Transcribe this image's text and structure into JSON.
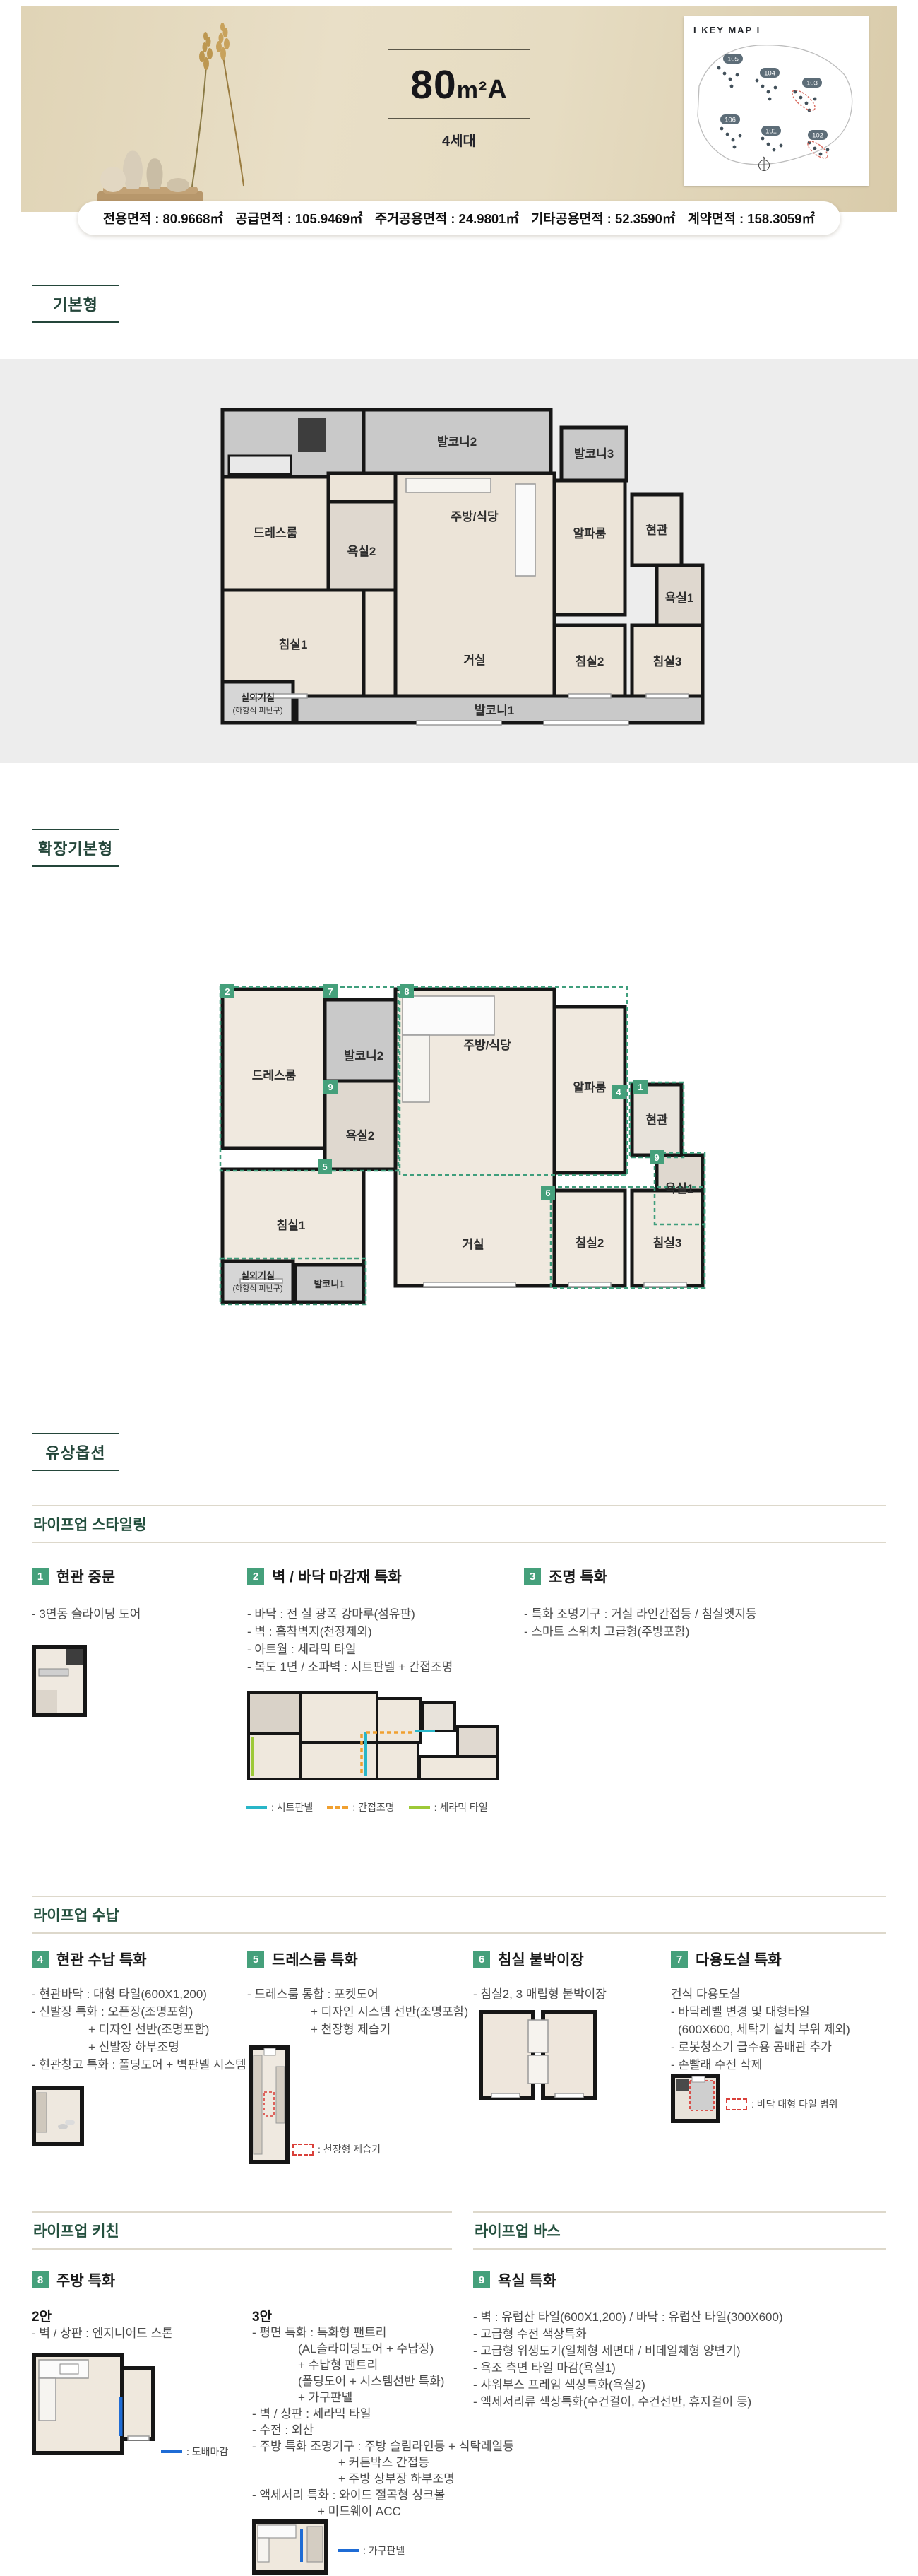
{
  "header": {
    "title_area": "80",
    "title_unit": "m²",
    "title_variant": "A",
    "units_count": "4세대",
    "keymap_title": "I KEY MAP I",
    "keymap_buildings": [
      "105",
      "104",
      "103",
      "106",
      "101",
      "102"
    ],
    "compass_label": "N",
    "area_info": [
      "전용면적 : 80.9668㎡",
      "공급면적 : 105.9469㎡",
      "주거공용면적 : 24.9801㎡",
      "기타공용면적 : 52.3590㎡",
      "계약면적 : 158.3059㎡"
    ]
  },
  "section_labels": {
    "basic": "기본형",
    "extended": "확장기본형",
    "paid": "유상옵션"
  },
  "plan_basic": {
    "rooms": {
      "balcony2": "발코니2",
      "balcony3": "발코니3",
      "dressroom": "드레스룸",
      "bath2": "욕실2",
      "kitchen": "주방/식당",
      "alpha": "알파룸",
      "entrance": "현관",
      "bath1": "욕실1",
      "bed1": "침실1",
      "living": "거실",
      "bed2": "침실2",
      "bed3": "침실3",
      "balcony1": "발코니1",
      "outdoor": "실외기실",
      "outdoor_sub": "(하향식 피난구)"
    }
  },
  "plan_extended": {
    "rooms": {
      "dressroom": "드레스룸",
      "balcony2": "발코니2",
      "bath2": "욕실2",
      "kitchen": "주방/식당",
      "alpha": "알파룸",
      "entrance": "현관",
      "bath1": "욕실1",
      "bed1": "침실1",
      "living": "거실",
      "bed2": "침실2",
      "bed3": "침실3",
      "outdoor": "실외기실",
      "outdoor_sub": "(하향식 피난구)",
      "balcony1": "발코니1"
    },
    "markers": {
      "m2": "2",
      "m7": "7",
      "m8": "8",
      "m9a": "9",
      "m5": "5",
      "m4": "4",
      "m1": "1",
      "m9b": "9",
      "m6": "6"
    }
  },
  "lifeup_styling": {
    "heading": "라이프업 스타일링",
    "item1": {
      "no": "1",
      "title": "현관 중문",
      "d0": "- 3연동 슬라이딩 도어"
    },
    "item2": {
      "no": "2",
      "title": "벽 / 바닥 마감재 특화",
      "d0": "- 바닥 : 전 실 광폭 강마루(섬유판)",
      "d1": "- 벽 : 흡착벽지(천장제외)",
      "d2": "- 아트월 : 세라믹 타일",
      "d3": "- 복도 1면 / 소파벽 : 시트판넬 + 간접조명",
      "legend_sheet": ": 시트판넬",
      "legend_light": ": 간접조명",
      "legend_tile": ": 세라믹 타일"
    },
    "item3": {
      "no": "3",
      "title": "조명 특화",
      "d0": "- 특화 조명기구 : 거실 라인간접등 / 침실엣지등",
      "d1": "- 스마트 스위치 고급형(주방포함)"
    }
  },
  "lifeup_storage": {
    "heading": "라이프업 수납",
    "item4": {
      "no": "4",
      "title": "현관 수납 특화",
      "d0": "- 현관바닥 : 대형 타일(600X1,200)",
      "d1": "- 신발장 특화 : 오픈장(조명포함)",
      "d2": "+ 디자인 선반(조명포함)",
      "d3": "+ 신발장 하부조명",
      "d4": "- 현관창고 특화 : 폴딩도어 + 벽판넬 시스템 선반"
    },
    "item5": {
      "no": "5",
      "title": "드레스룸 특화",
      "d0": "- 드레스룸 통합 : 포켓도어",
      "d1": "+ 디자인 시스템 선반(조명포함)",
      "d2": "+ 천장형 제습기",
      "legend": ": 천장형 제습기"
    },
    "item6": {
      "no": "6",
      "title": "침실 붙박이장",
      "d0": "- 침실2, 3 매립형 붙박이장"
    },
    "item7": {
      "no": "7",
      "title": "다용도실 특화",
      "d0": "건식 다용도실",
      "d1": "- 바닥레벨 변경 및 대형타일",
      "d2": "(600X600, 세탁기 설치 부위 제외)",
      "d3": "- 로봇청소기 급수용 공배관 추가",
      "d4": "- 손빨래 수전 삭제",
      "legend": ": 바닥 대형 타일 범위"
    }
  },
  "lifeup_kitchen": {
    "heading": "라이프업 키친",
    "item8": {
      "no": "8",
      "title": "주방 특화",
      "opt2_label": "2안",
      "opt2_d0": "- 벽 / 상판 : 엔지니어드 스톤",
      "opt2_legend": ": 도배마감",
      "opt3_label": "3안",
      "opt3_d0": "- 평면 특화 : 특화형 팬트리",
      "opt3_d1": "(AL슬라이딩도어 + 수납장)",
      "opt3_d2": "+ 수납형 팬트리",
      "opt3_d3": "(폴딩도어 + 시스템선반 특화)",
      "opt3_d4": "+ 가구판넬",
      "opt3_d5": "- 벽 / 상판 : 세라믹 타일",
      "opt3_d6": "- 수전 : 외산",
      "opt3_d7": "- 주방 특화 조명기구 : 주방 슬림라인등 + 식탁레일등",
      "opt3_d8": "+ 커튼박스 간접등",
      "opt3_d9": "+ 주방 상부장 하부조명",
      "opt3_d10": "- 액세서리 특화 : 와이드 절곡형 싱크볼",
      "opt3_d11": "+ 미드웨이 ACC",
      "opt3_legend": ": 가구판넬"
    }
  },
  "lifeup_bath": {
    "heading": "라이프업 바스",
    "item9": {
      "no": "9",
      "title": "욕실 특화",
      "d0": "- 벽 : 유럽산 타일(600X1,200) / 바닥 : 유럽산 타일(300X600)",
      "d1": "- 고급형 수전 색상특화",
      "d2": "- 고급형 위생도기(일체형 세면대 / 비데일체형 양변기)",
      "d3": "- 욕조 측면 타일 마감(욕실1)",
      "d4": "- 샤워부스 프레임 색상특화(욕실2)",
      "d5": "- 액세서리류 색상특화(수건걸이, 수건선반, 휴지걸이 등)"
    }
  },
  "colors": {
    "accent_green": "#45a07b",
    "heading_green": "#24503e",
    "label_green": "#24463a",
    "legend_teal": "#29b6c8",
    "legend_orange": "#f0a030",
    "legend_lime": "#9dc938",
    "legend_blue": "#1f6cd5",
    "legend_red": "#d9403a",
    "hero_beige": "#e6dcc2"
  }
}
